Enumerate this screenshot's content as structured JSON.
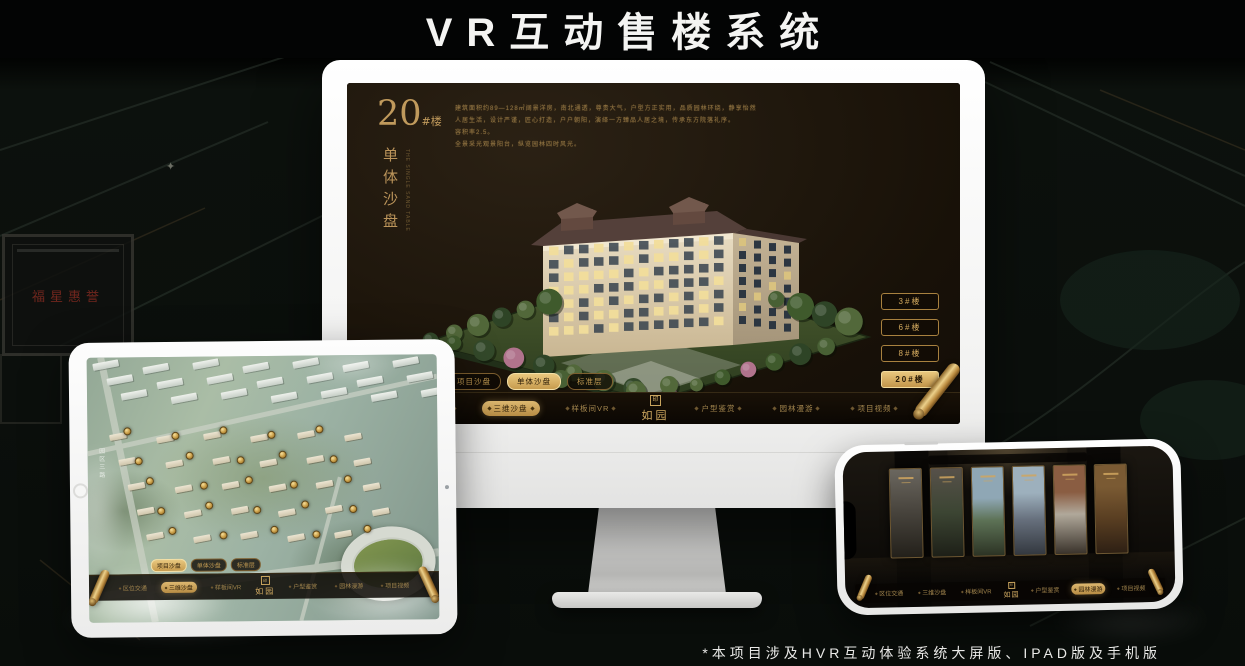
{
  "page": {
    "title": "VR互动售楼系统",
    "footnote": "*本项目涉及HVR互动体验系统大屏版、IPAD版及手机版"
  },
  "brand": {
    "name": "如园",
    "seal_char": "印"
  },
  "background": {
    "plaque_text": "福星惠誉"
  },
  "colors": {
    "gold": "#c9a05f",
    "gold_bright": "#e8c87e",
    "screen_bg": "#17100a",
    "title_color": "#f4f4f2"
  },
  "monitor_app": {
    "building_number": "20",
    "building_suffix": "#楼",
    "page_title_vertical": "单体沙盘",
    "page_title_caption": "THE SINGLE SAND TABLE",
    "description_lines": [
      "建筑面积约89—128㎡阔景洋房，南北通透，尊贵大气，户型方正实用，品质园林环绕，静享怡然",
      "人居生活，设计严谨，匠心打造，户户朝阳，演绎一方臻品人居之境，传承东方院落礼序。",
      "容积率2.5。",
      "全景采光观景阳台，纵览园林四时风光。"
    ],
    "floor_buttons": [
      {
        "label": "3#楼",
        "active": false
      },
      {
        "label": "6#楼",
        "active": false
      },
      {
        "label": "8#楼",
        "active": false
      },
      {
        "label": "20#楼",
        "active": true
      }
    ],
    "sub_tabs": [
      {
        "label": "项目沙盘",
        "active": false
      },
      {
        "label": "单体沙盘",
        "active": true
      },
      {
        "label": "标准层",
        "active": false
      }
    ],
    "nav_items": [
      {
        "label": "区位交通",
        "active": false
      },
      {
        "label": "三维沙盘",
        "active": true
      },
      {
        "label": "样板间VR",
        "active": false
      },
      {
        "label": "户型鉴赏",
        "active": false
      },
      {
        "label": "园林漫游",
        "active": false
      },
      {
        "label": "项目视频",
        "active": false
      }
    ]
  },
  "tablet_app": {
    "map_label": "园区三路",
    "sub_tabs": [
      {
        "label": "项目沙盘",
        "active": true
      },
      {
        "label": "单体沙盘",
        "active": false
      },
      {
        "label": "标准层",
        "active": false
      }
    ],
    "nav_items": [
      {
        "label": "区位交通",
        "active": false
      },
      {
        "label": "三维沙盘",
        "active": true
      },
      {
        "label": "样板间VR",
        "active": false
      },
      {
        "label": "户型鉴赏",
        "active": false
      },
      {
        "label": "园林漫游",
        "active": false
      },
      {
        "label": "项目视频",
        "active": false
      }
    ]
  },
  "phone_app": {
    "nav_items": [
      {
        "label": "区位交通",
        "active": false
      },
      {
        "label": "三维沙盘",
        "active": false
      },
      {
        "label": "样板间VR",
        "active": false
      },
      {
        "label": "户型鉴赏",
        "active": false
      },
      {
        "label": "园林漫游",
        "active": true
      },
      {
        "label": "项目视频",
        "active": false
      }
    ]
  }
}
